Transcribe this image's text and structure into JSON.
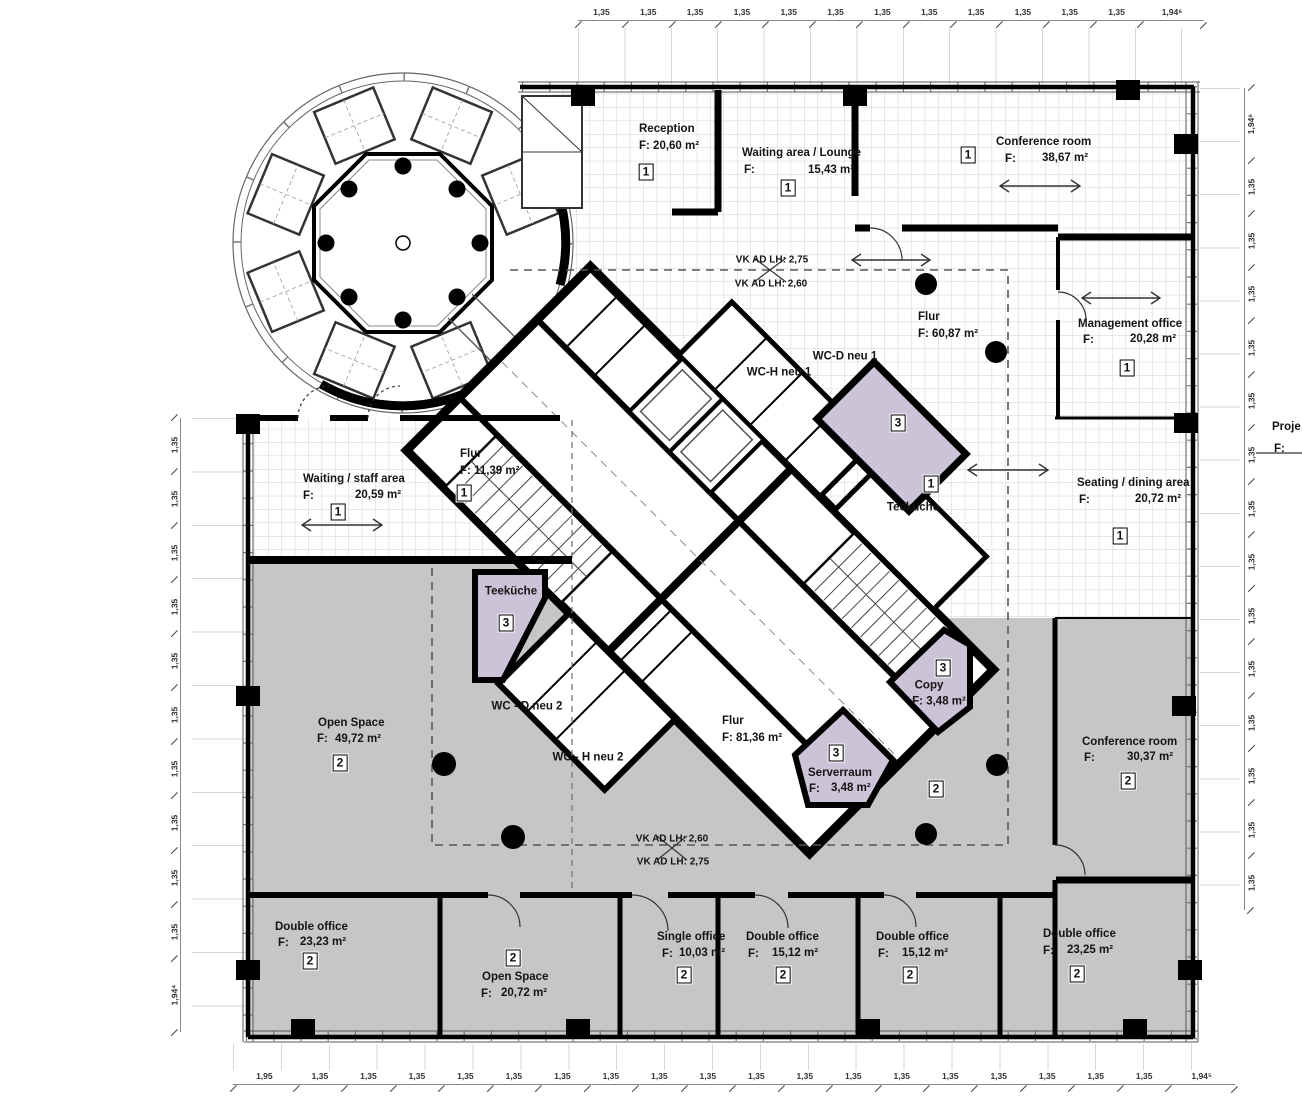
{
  "colors": {
    "gray_zone": "#c6c6c6",
    "purple_zone": "#cdc3d8",
    "wall": "#000000",
    "grid_line": "#cfcfcf"
  },
  "labels": {
    "f": "F:"
  },
  "rooms": {
    "reception": {
      "name": "Reception",
      "area": "F: 20,60 m²",
      "badge": "1"
    },
    "waiting_lounge": {
      "name": "Waiting area / Lounge",
      "area": "15,43 m²",
      "badge": "1"
    },
    "conference_1": {
      "name": "Conference room",
      "area": "38,67 m²",
      "badge": "1"
    },
    "management": {
      "name": "Management office",
      "area": "20,28 m²",
      "badge": "1"
    },
    "flur_upper": {
      "name": "Flur",
      "area": "F: 60,87 m²"
    },
    "wc_h_1": {
      "name": "WC-H neu 1"
    },
    "wc_d_1": {
      "name": "WC-D neu 1"
    },
    "store_ne": {
      "badge": "3"
    },
    "teekueche_east": {
      "name": "Teeküche",
      "badge": "1"
    },
    "seating_dining": {
      "name": "Seating / dining area",
      "area": "20,72 m²",
      "badge": "1"
    },
    "waiting_staff": {
      "name": "Waiting / staff area",
      "area": "20,59 m²",
      "badge": "1"
    },
    "flur_west": {
      "name": "Flur",
      "area": "F: 11,39 m²",
      "badge": "1"
    },
    "teekueche_west": {
      "name": "Teeküche",
      "badge": "3"
    },
    "wc_d_2": {
      "name": "WC - D neu 2"
    },
    "wc_h_2": {
      "name": "WC - H neu 2"
    },
    "flur_central": {
      "name": "Flur",
      "area": "F: 81,36 m²"
    },
    "copy": {
      "name": "Copy",
      "area": "F: 3,48 m²",
      "badge": "3"
    },
    "server": {
      "name": "Serverraum",
      "area": "3,48 m²",
      "badge": "3"
    },
    "zone2_marker": {
      "badge": "2"
    },
    "open_space_1": {
      "name": "Open Space",
      "area": "49,72 m²",
      "badge": "2"
    },
    "conference_2": {
      "name": "Conference room",
      "area": "30,37 m²",
      "badge": "2"
    },
    "double_office_1": {
      "name": "Double office",
      "area": "23,23 m²",
      "badge": "2"
    },
    "open_space_2": {
      "name": "Open Space",
      "area": "20,72 m²",
      "badge": "2"
    },
    "single_office": {
      "name": "Single office",
      "area": "10,03 m²",
      "badge": "2"
    },
    "double_office_2": {
      "name": "Double office",
      "area": "15,12 m²",
      "badge": "2"
    },
    "double_office_3": {
      "name": "Double office",
      "area": "15,12 m²",
      "badge": "2"
    },
    "double_office_4": {
      "name": "Double office",
      "area": "23,25 m²",
      "badge": "2"
    }
  },
  "annotations": {
    "vk_top_upper": "VK AD LH: 2,75",
    "vk_top_lower": "VK AD LH: 2,60",
    "vk_bottom_upper": "VK AD LH: 2,60",
    "vk_bottom_lower": "VK AD LH: 2,75",
    "edge_note_title": "Proje",
    "edge_note_f": "F:"
  },
  "dimensions": {
    "top": [
      "1,35",
      "1,35",
      "1,35",
      "1,35",
      "1,35",
      "1,35",
      "1,35",
      "1,35",
      "1,35",
      "1,35",
      "1,35",
      "1,35",
      "1,94⁶"
    ],
    "bottom": [
      "1,95",
      "1,35",
      "1,35",
      "1,35",
      "1,35",
      "1,35",
      "1,35",
      "1,35",
      "1,35",
      "1,35",
      "1,35",
      "1,35",
      "1,35",
      "1,35",
      "1,35",
      "1,35",
      "1,35",
      "1,35",
      "1,35",
      "1,94⁵"
    ],
    "left": [
      "1,35",
      "1,35",
      "1,35",
      "1,35",
      "1,35",
      "1,35",
      "1,35",
      "1,35",
      "1,35",
      "1,35",
      "1,94⁴"
    ],
    "right": [
      "1,94⁶",
      "1,35",
      "1,35",
      "1,35",
      "1,35",
      "1,35",
      "1,35",
      "1,35",
      "1,35",
      "1,35",
      "1,35",
      "1,35",
      "1,35",
      "1,35",
      "1,35"
    ]
  }
}
